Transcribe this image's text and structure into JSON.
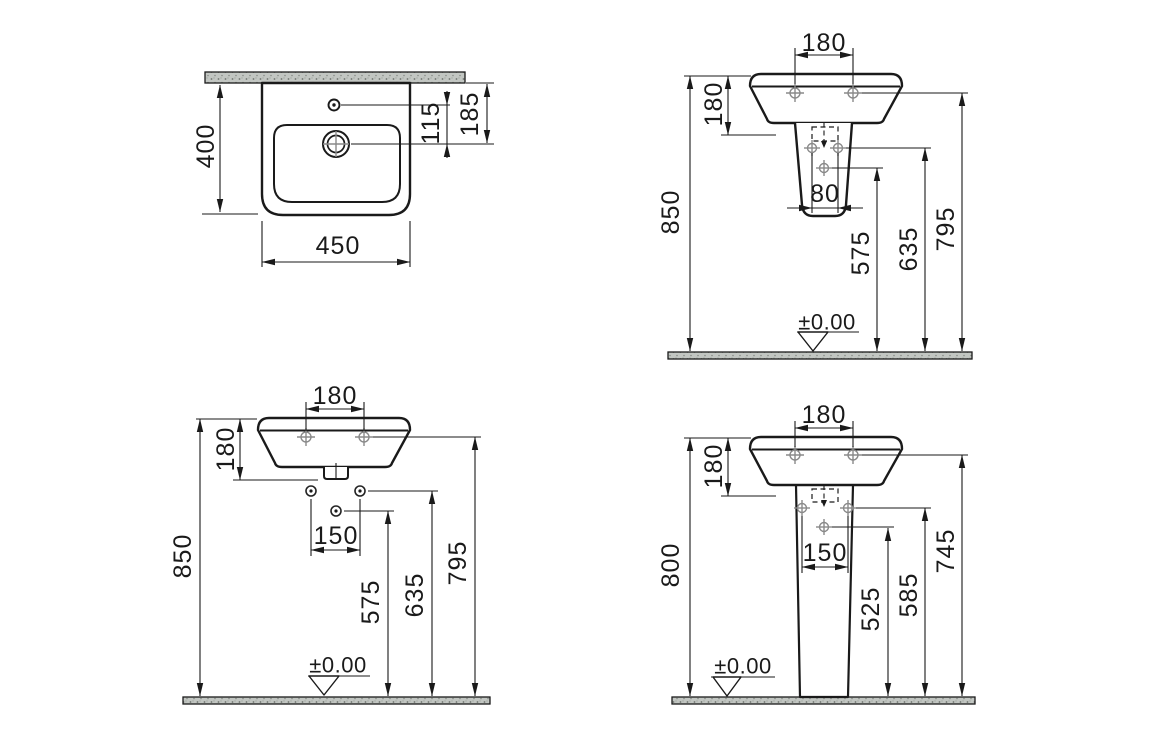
{
  "colors": {
    "line": "#1a1a1a",
    "hole_marker": "#8a8a8a",
    "surface_fill": "#c9cdc9",
    "background": "#ffffff"
  },
  "views": {
    "plan": {
      "dims": {
        "depth": "400",
        "width": "450",
        "tap_to_drain": "115",
        "wall_to_drain": "185"
      }
    },
    "half_pedestal": {
      "dims": {
        "fixing_span": "180",
        "basin_depth": "180",
        "pedestal_fixing_span": "80",
        "rim_height": "850",
        "outlet_height": "575",
        "pedestal_fixing_height": "635",
        "fixing_height": "795"
      },
      "datum_label": "±0.00"
    },
    "wall_hung": {
      "dims": {
        "fixing_span": "180",
        "basin_depth": "180",
        "bracket_span": "150",
        "rim_height": "850",
        "outlet_height": "575",
        "bracket_height": "635",
        "fixing_height": "795"
      },
      "datum_label": "±0.00"
    },
    "pedestal": {
      "dims": {
        "fixing_span": "180",
        "basin_depth": "180",
        "pedestal_fixing_span": "150",
        "rim_height": "800",
        "outlet_height": "525",
        "pedestal_fixing_height": "585",
        "fixing_height": "745"
      },
      "datum_label": "±0.00"
    }
  }
}
